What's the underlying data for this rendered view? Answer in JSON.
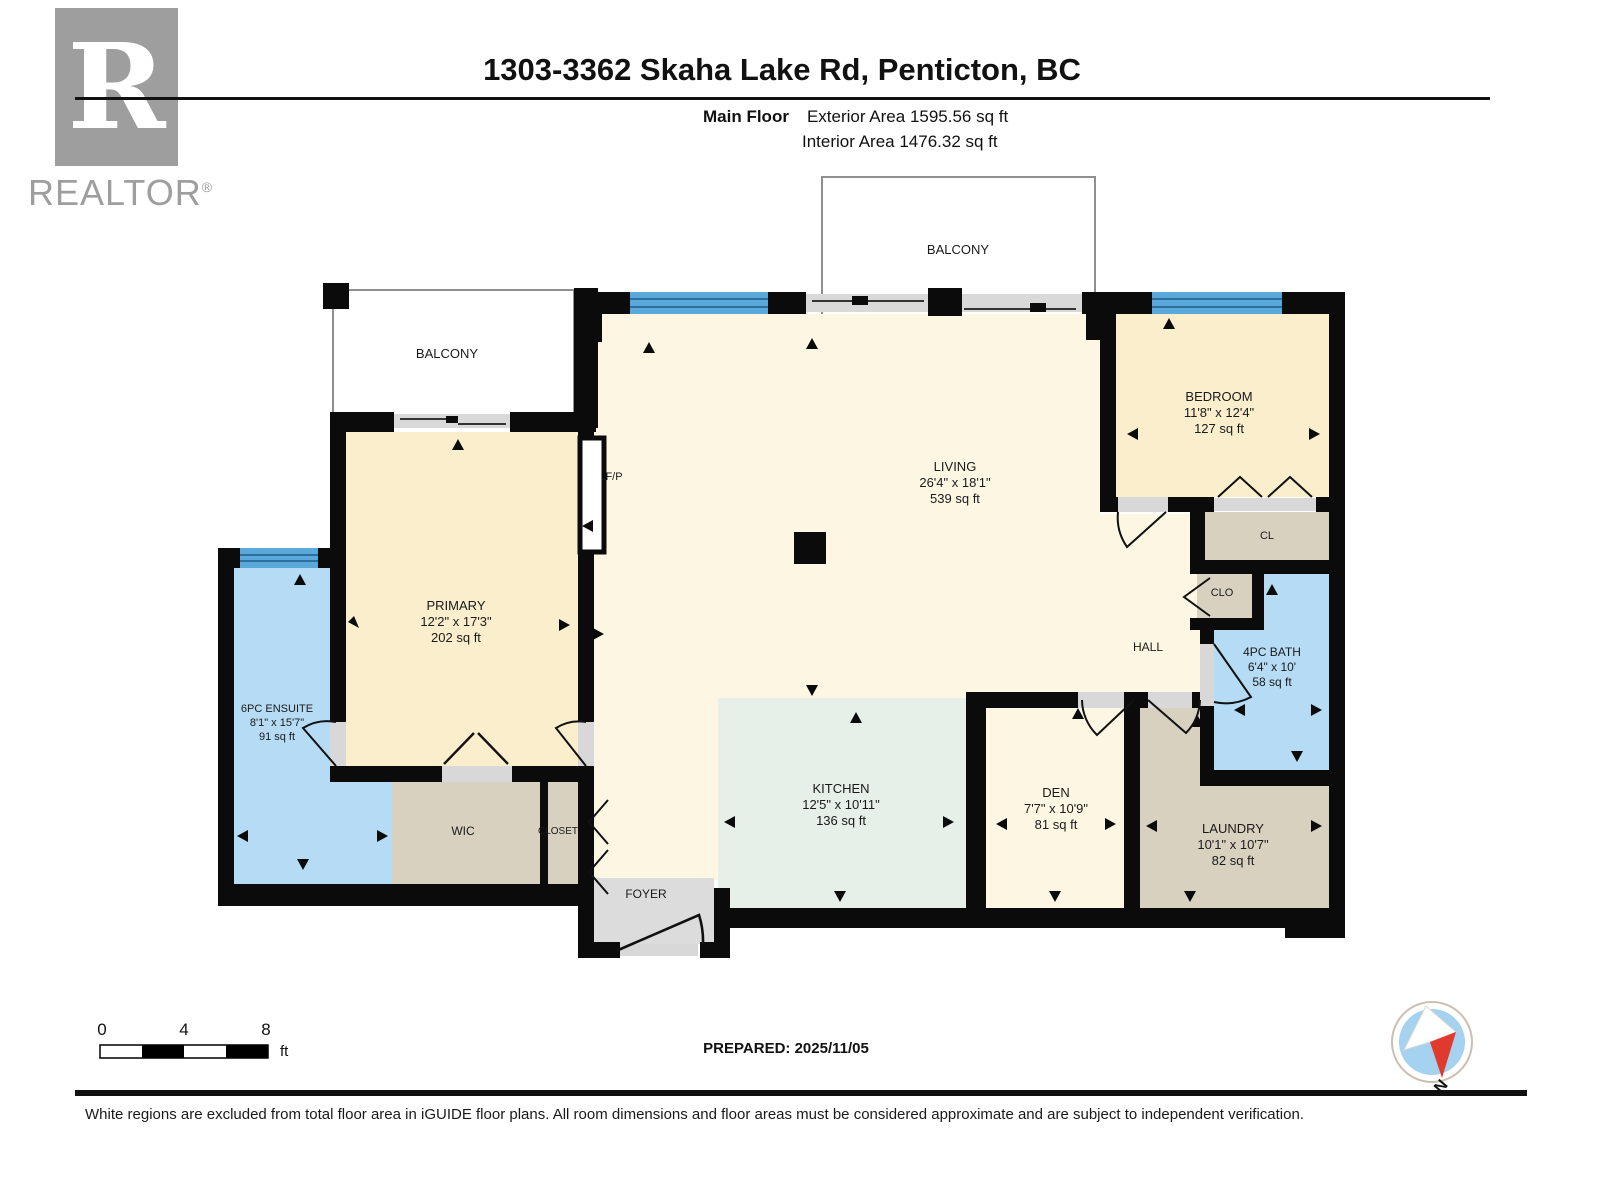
{
  "header": {
    "title": "1303-3362 Skaha Lake Rd, Penticton, BC",
    "floor_label": "Main Floor",
    "exterior_area_label": "Exterior Area 1595.56 sq ft",
    "interior_area_label": "Interior Area 1476.32 sq ft"
  },
  "logo": {
    "letter": "R",
    "brand": "REALTOR",
    "registered": "®"
  },
  "rooms": {
    "balcony_top": {
      "name": "BALCONY"
    },
    "balcony_left": {
      "name": "BALCONY"
    },
    "living": {
      "name": "LIVING",
      "dims": "26'4\" x 18'1\"",
      "area": "539 sq ft"
    },
    "primary": {
      "name": "PRIMARY",
      "dims": "12'2\" x 17'3\"",
      "area": "202 sq ft"
    },
    "bedroom": {
      "name": "BEDROOM",
      "dims": "11'8\" x 12'4\"",
      "area": "127 sq ft"
    },
    "ensuite": {
      "name": "6PC ENSUITE",
      "dims": "8'1\" x 15'7\"",
      "area": "91 sq ft"
    },
    "bath": {
      "name": "4PC BATH",
      "dims": "6'4\" x 10'",
      "area": "58 sq ft"
    },
    "kitchen": {
      "name": "KITCHEN",
      "dims": "12'5\" x 10'11\"",
      "area": "136 sq ft"
    },
    "den": {
      "name": "DEN",
      "dims": "7'7\" x 10'9\"",
      "area": "81 sq ft"
    },
    "laundry": {
      "name": "LAUNDRY",
      "dims": "10'1\" x 10'7\"",
      "area": "82 sq ft"
    },
    "wic": {
      "name": "WIC"
    },
    "closet": {
      "name": "CLOSET"
    },
    "foyer": {
      "name": "FOYER"
    },
    "hall": {
      "name": "HALL"
    },
    "cl": {
      "name": "CL"
    },
    "clo": {
      "name": "CLO"
    },
    "fireplace": {
      "name": "F/P"
    }
  },
  "scale_bar": {
    "tick_0": "0",
    "tick_4": "4",
    "tick_8": "8",
    "unit": "ft"
  },
  "prepared_label": "PREPARED: 2025/11/05",
  "compass": {
    "north_label": "N"
  },
  "footer": {
    "disclaimer": "White regions are excluded from total floor area in iGUIDE floor plans. All room dimensions and floor areas must be considered approximate and are subject to independent verification."
  },
  "colors": {
    "room_cream": "#fdf6e3",
    "room_gold": "#faeecd",
    "room_blue": "#b5dcf4",
    "room_mint": "#e6efe8",
    "room_tan": "#d9d1c0",
    "foyer_gray": "#dcdcdc",
    "window_blue": "#5aa9da",
    "wall_black": "#0b0b0b",
    "compass_red": "#e03a2f",
    "compass_blue": "#a5d2ef"
  }
}
